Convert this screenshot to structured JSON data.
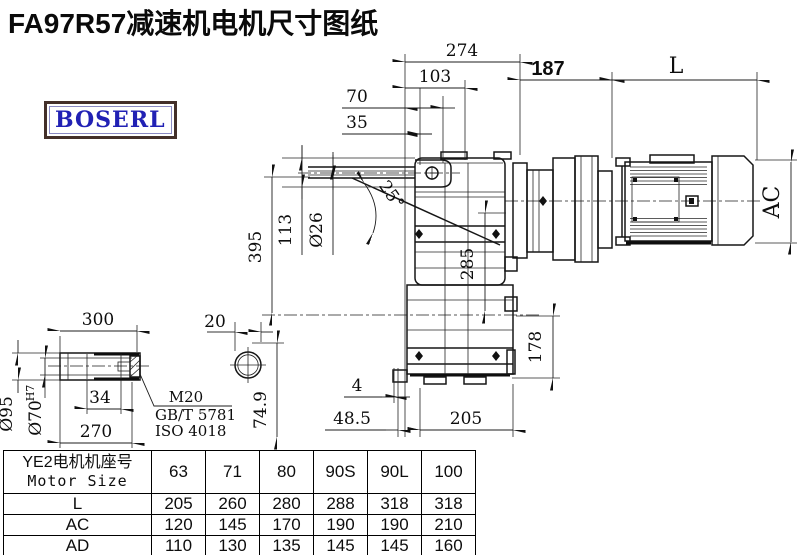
{
  "title": "FA97R57减速机电机尺寸图纸",
  "logo": "BOSERL",
  "dims": {
    "d274": "274",
    "d103": "103",
    "d70": "70",
    "d35": "35",
    "d187": "187",
    "dL": "L",
    "dAC": "AC",
    "d395": "395",
    "d113": "113",
    "dia26": "Ø26",
    "angle25": "25°",
    "d285": "285",
    "d178": "178",
    "d4": "4",
    "d48_5": "48.5",
    "d205": "205",
    "d20": "20",
    "d74_9": "74.9",
    "d300": "300",
    "dia95": "Ø95",
    "dia70": "Ø70",
    "tol70": "H7",
    "d34": "34",
    "d270": "270",
    "thread": "M20",
    "std_gb": "GB/T 5781",
    "std_iso": "ISO 4018"
  },
  "table": {
    "header_cn": "YE2电机机座号",
    "header_en": "Motor Size",
    "columns": [
      "63",
      "71",
      "80",
      "90S",
      "90L",
      "100"
    ],
    "rows": [
      {
        "label": "L",
        "values": [
          "205",
          "260",
          "280",
          "288",
          "318",
          "318"
        ]
      },
      {
        "label": "AC",
        "values": [
          "120",
          "145",
          "170",
          "190",
          "190",
          "210"
        ]
      },
      {
        "label": "AD",
        "values": [
          "110",
          "130",
          "135",
          "145",
          "145",
          "160"
        ]
      }
    ]
  }
}
